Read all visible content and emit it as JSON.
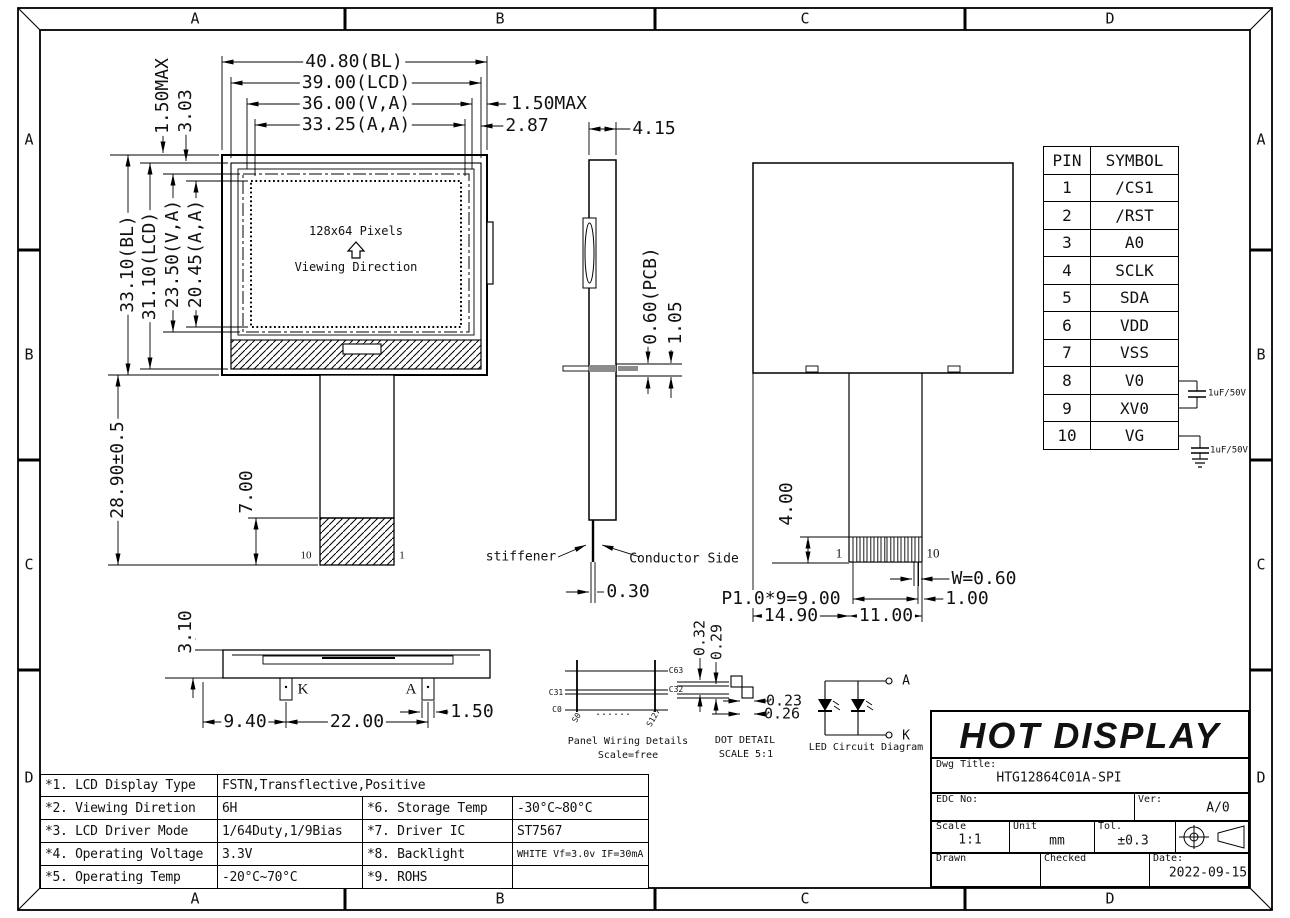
{
  "frame": {
    "cols": [
      "A",
      "B",
      "C",
      "D"
    ],
    "rows": [
      "A",
      "B",
      "C",
      "D"
    ]
  },
  "fv": {
    "dim_bl_w": "40.80(BL)",
    "dim_lcd_w": "39.00(LCD)",
    "dim_va_w": "36.00(V,A)",
    "dim_aa_w": "33.25(A,A)",
    "dim_150max_right": "1.50MAX",
    "dim_287": "2.87",
    "dim_150max_top": "1.50MAX",
    "dim_303": "3.03",
    "dim_bl_h": "33.10(BL)",
    "dim_lcd_h": "31.10(LCD)",
    "dim_va_h": "23.50(V,A)",
    "dim_aa_h": "20.45(A,A)",
    "dim_tail": "28.90±0.5",
    "dim_tail_hatch": "7.00",
    "pin10": "10",
    "pin1": "1",
    "pixels": "128x64 Pixels",
    "viewing": "Viewing Direction"
  },
  "sv": {
    "dim_thick": "4.15",
    "dim_pcb": "0.60(PCB)",
    "dim_105": "1.05",
    "stiffener": "stiffener",
    "conductor": "Conductor Side",
    "dim_fpc": "0.30"
  },
  "bv": {
    "dim_400": "4.00",
    "pin1": "1",
    "pin10": "10",
    "dim_w": "W=0.60",
    "dim_pitch": "P1.0*9=9.00",
    "dim_1490": "14.90",
    "dim_1100": "11.00",
    "dim_100": "1.00"
  },
  "pins": {
    "h_pin": "PIN",
    "h_symbol": "SYMBOL",
    "rows": [
      {
        "pin": "1",
        "symbol": "/CS1"
      },
      {
        "pin": "2",
        "symbol": "/RST"
      },
      {
        "pin": "3",
        "symbol": "A0"
      },
      {
        "pin": "4",
        "symbol": "SCLK"
      },
      {
        "pin": "5",
        "symbol": "SDA"
      },
      {
        "pin": "6",
        "symbol": "VDD"
      },
      {
        "pin": "7",
        "symbol": "VSS"
      },
      {
        "pin": "8",
        "symbol": "V0"
      },
      {
        "pin": "9",
        "symbol": "XV0"
      },
      {
        "pin": "10",
        "symbol": "VG"
      }
    ],
    "cap1": "1uF/50V",
    "cap2": "1uF/50V"
  },
  "bot": {
    "dim_310": "3.10",
    "k": "K",
    "a": "A",
    "dim_940": "9.40",
    "dim_2200": "22.00",
    "dim_150": "1.50"
  },
  "pw": {
    "c63": "C63",
    "c32": "C32",
    "c31": "C31",
    "c0": "C0",
    "s0": "S0",
    "s127": "S127",
    "dots": "......",
    "title": "Panel Wiring Details",
    "scale": "Scale=free"
  },
  "dot": {
    "d032": "0.32",
    "d029": "0.29",
    "d023": "0.23",
    "d026": "0.26",
    "title": "DOT DETAIL",
    "scale": "SCALE 5:1"
  },
  "led": {
    "a": "A",
    "k": "K",
    "title": "LED Circuit Diagram"
  },
  "spec": {
    "r1_label": "*1. LCD Display Type",
    "r1_value": "FSTN,Transflective,Positive",
    "rows": [
      {
        "l": "*2. Viewing Diretion",
        "v": "6H",
        "l2": "*6. Storage Temp",
        "v2": "-30°C~80°C"
      },
      {
        "l": "*3. LCD Driver Mode",
        "v": "1/64Duty,1/9Bias",
        "l2": "*7. Driver IC",
        "v2": "ST7567"
      },
      {
        "l": "*4. Operating Voltage",
        "v": "3.3V",
        "l2": "*8. Backlight",
        "v2": "WHITE Vf=3.0v IF=30mA"
      },
      {
        "l": "*5. Operating Temp",
        "v": "-20°C~70°C",
        "l2": "*9. ROHS",
        "v2": ""
      }
    ]
  },
  "tb": {
    "company": "HOT DISPLAY",
    "dwg_label": "Dwg Title:",
    "dwg_value": "HTG12864C01A-SPI",
    "edc_label": "EDC No:",
    "ver_label": "Ver:",
    "ver_value": "A/0",
    "scale_label": "Scale",
    "scale_value": "1:1",
    "unit_label": "Unit",
    "unit_value": "mm",
    "tol_label": "Tol.",
    "tol_value": "±0.3",
    "drawn_label": "Drawn",
    "checked_label": "Checked",
    "date_label": "Date:",
    "date_value": "2022-09-15"
  }
}
